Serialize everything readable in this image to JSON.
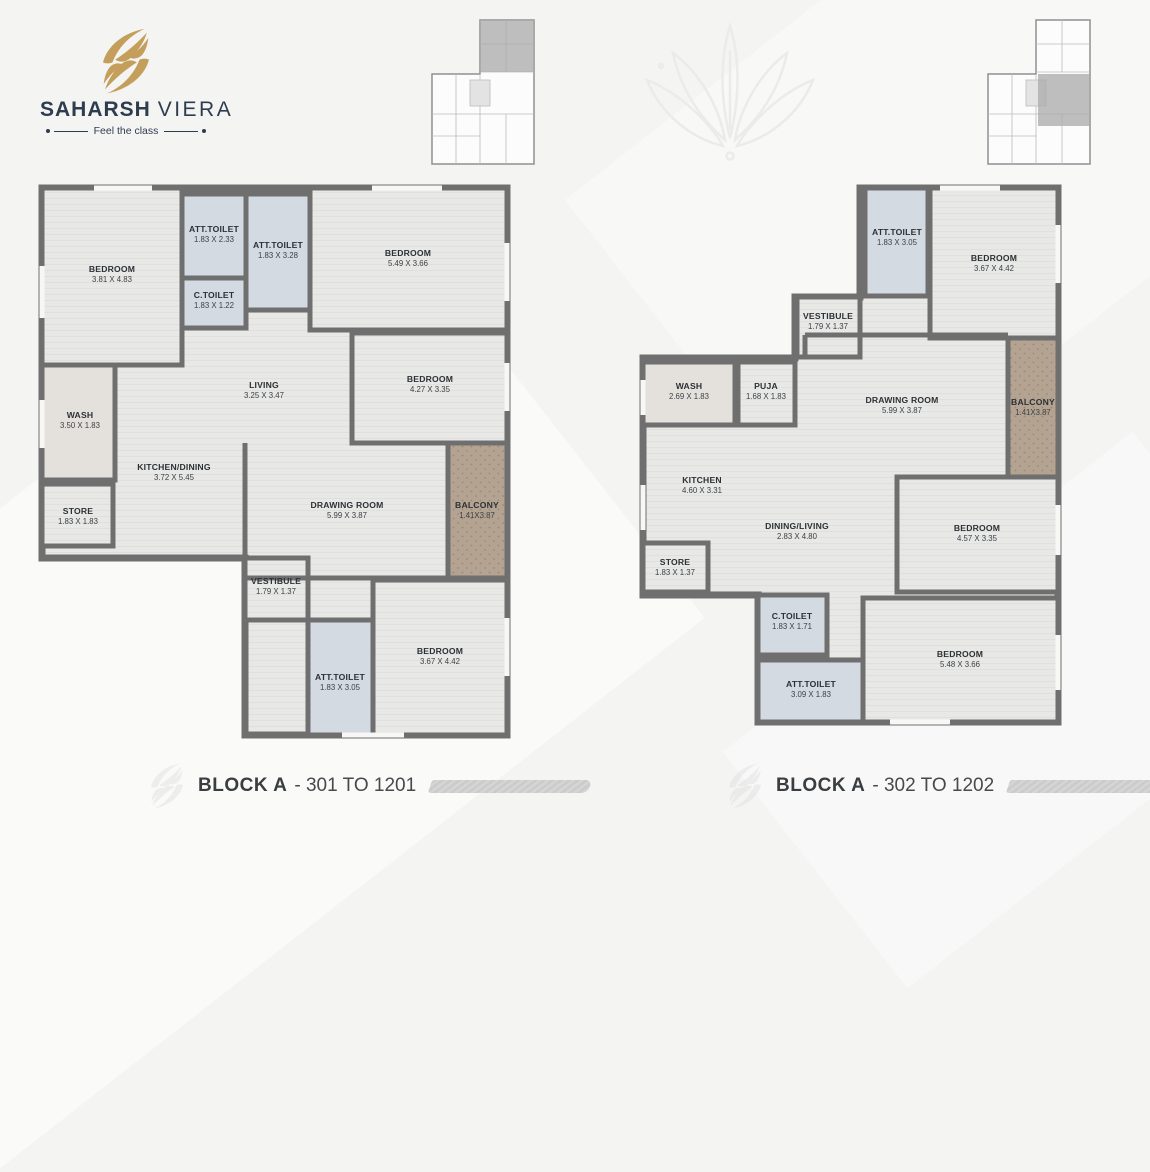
{
  "brand": {
    "name_bold": "SAHARSH",
    "name_light": "VIERA",
    "tagline": "Feel the class"
  },
  "plans": [
    {
      "title_bold": "BLOCK A",
      "title_rest": "- 301 TO 1201",
      "rooms": [
        {
          "name": "BEDROOM",
          "dims": "3.81 X 4.83"
        },
        {
          "name": "ATT.TOILET",
          "dims": "1.83 X 2.33"
        },
        {
          "name": "C.TOILET",
          "dims": "1.83 X 1.22"
        },
        {
          "name": "ATT.TOILET",
          "dims": "1.83 X 3.28"
        },
        {
          "name": "BEDROOM",
          "dims": "5.49 X 3.66"
        },
        {
          "name": "BEDROOM",
          "dims": "4.27 X 3.35"
        },
        {
          "name": "LIVING",
          "dims": "3.25 X 3.47"
        },
        {
          "name": "WASH",
          "dims": "3.50 X 1.83"
        },
        {
          "name": "KITCHEN/DINING",
          "dims": "3.72 X 5.45"
        },
        {
          "name": "STORE",
          "dims": "1.83 X 1.83"
        },
        {
          "name": "DRAWING ROOM",
          "dims": "5.99 X 3.87"
        },
        {
          "name": "BALCONY",
          "dims": "1.41X3.87"
        },
        {
          "name": "VESTIBULE",
          "dims": "1.79 X 1.37"
        },
        {
          "name": "ATT.TOILET",
          "dims": "1.83 X 3.05"
        },
        {
          "name": "BEDROOM",
          "dims": "3.67 X 4.42"
        }
      ]
    },
    {
      "title_bold": "BLOCK A",
      "title_rest": "- 302 TO 1202",
      "rooms": [
        {
          "name": "ATT.TOILET",
          "dims": "1.83 X 3.05"
        },
        {
          "name": "BEDROOM",
          "dims": "3.67 X 4.42"
        },
        {
          "name": "VESTIBULE",
          "dims": "1.79 X 1.37"
        },
        {
          "name": "WASH",
          "dims": "2.69 X 1.83"
        },
        {
          "name": "PUJA",
          "dims": "1.68 X 1.83"
        },
        {
          "name": "DRAWING ROOM",
          "dims": "5.99 X 3.87"
        },
        {
          "name": "BALCONY",
          "dims": "1.41X3.87"
        },
        {
          "name": "KITCHEN",
          "dims": "4.60 X 3.31"
        },
        {
          "name": "DINING/LIVING",
          "dims": "2.83 X 4.80"
        },
        {
          "name": "BEDROOM",
          "dims": "4.57 X 3.35"
        },
        {
          "name": "STORE",
          "dims": "1.83 X 1.37"
        },
        {
          "name": "C.TOILET",
          "dims": "1.83 X 1.71"
        },
        {
          "name": "ATT.TOILET",
          "dims": "3.09 X 1.83"
        },
        {
          "name": "BEDROOM",
          "dims": "5.48 X 3.66"
        }
      ]
    }
  ],
  "colors": {
    "brand_gold": "#c39f5b",
    "brand_navy": "#2e3c50",
    "wall": "#6f6f6f",
    "floor": "#e8e8e6",
    "toilet_fill": "#d3dae1",
    "wash_fill": "#e4e1dd",
    "balcony_tan": "#b5a391",
    "title_text": "#3a3e41"
  }
}
